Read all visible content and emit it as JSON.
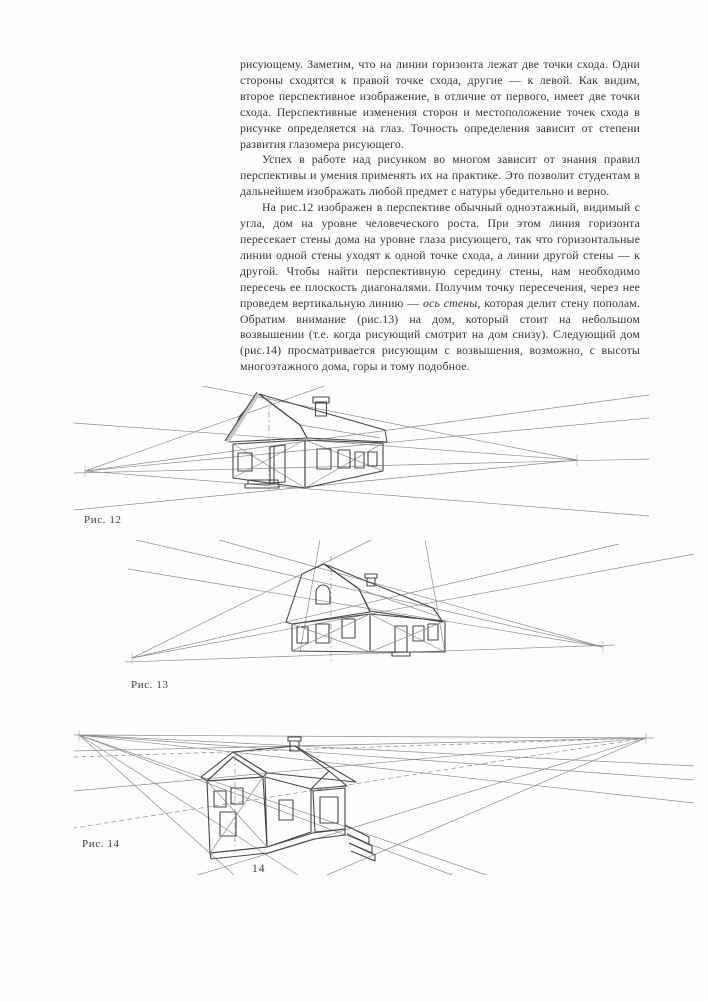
{
  "page": {
    "number": "14",
    "paper_color": "#fefefe",
    "ink_color": "#32323c"
  },
  "content": {
    "paragraphs": [
      {
        "indent": false,
        "text": "рисующему. Заметим, что  на линии горизонта лежат  две точки схода. Одни стороны сходятся к правой точке схода, другие — к левой. Как видим, второе перспективное изображение, в отличие от первого, имеет две точки схода. Перспективные изменения сторон и местоположение точек схода в рисунке определяется на глаз. Точность определения зависит от степени развития глазомера рисующего."
      },
      {
        "indent": true,
        "text": "Успех в работе над рисунком во многом зависит от знания правил перспективы и умения применять их на практике. Это позволит студентам в дальнейшем изображать любой предмет с натуры убедительно и верно."
      },
      {
        "indent": true,
        "text1": "На рис.12 изображен в перспективе обычный одноэтажный, видимый с угла, дом на уровне человеческого роста. При этом линия горизонта пересекает стены дома на уровне глаза рисующего, так  что горизонтальные линии одной стены уходят к одной точке схода, а линии другой стены — к другой. Чтобы найти перспективную середину стены, нам необходимо пересечь ее плоскость диагоналями. Получим точку пересечения, через нее проведем вертикальную линию — ",
        "italic": "ось стены",
        "text2": ", которая делит стену пополам. Обратим внимание (рис.13) на дом, который стоит на небольшом возвышении (т.е. когда рисующий смотрит на дом снизу). Следующий дом (рис.14) просматривается рисующим с возвышения, возможно, с высоты многоэтажного дома, горы и тому подобное."
      }
    ]
  },
  "figures": [
    {
      "caption": "Рис. 12",
      "description": "one-story house drawn in two-point perspective at eye level, horizon crossing the walls"
    },
    {
      "caption": "Рис. 13",
      "description": "house on a small rise seen from below, verticals converging upward"
    },
    {
      "caption": "Рис. 14",
      "description": "house seen from a high viewpoint, construction lines fanning down from the horizon"
    }
  ]
}
